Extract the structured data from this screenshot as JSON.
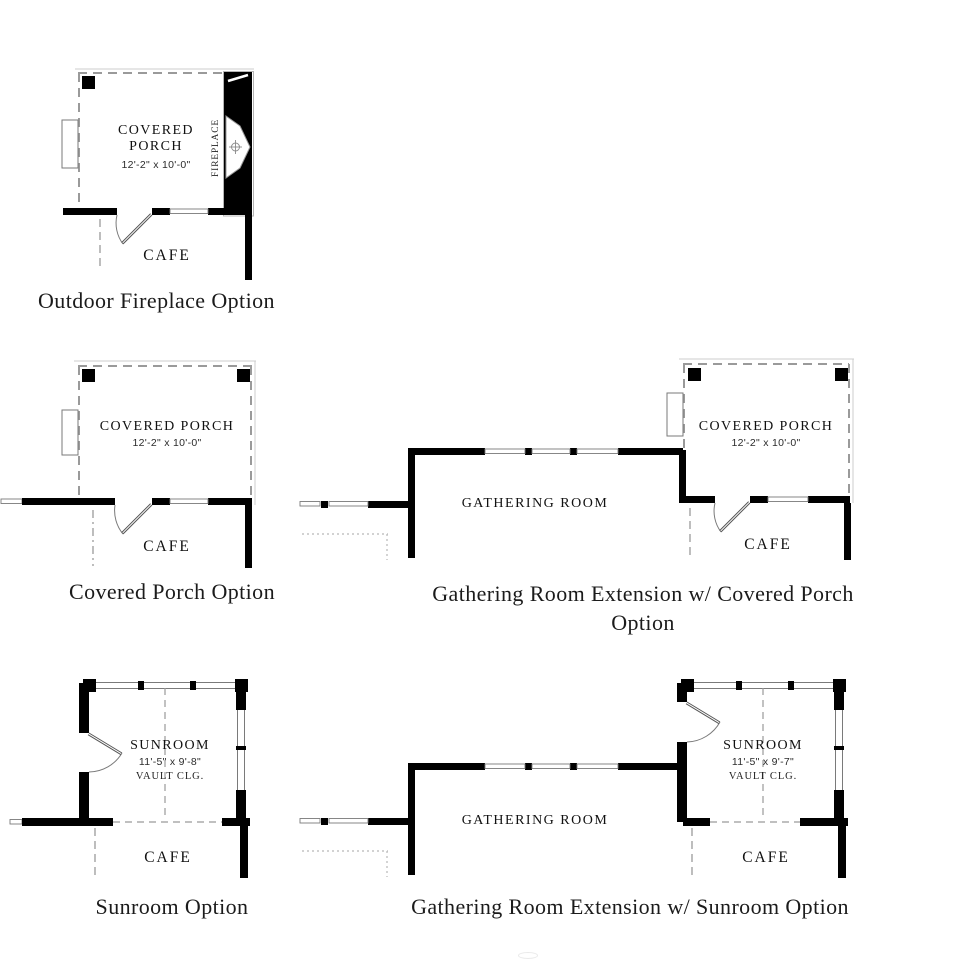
{
  "colors": {
    "wall": "#000000",
    "dashed_line": "#9a9a9a",
    "window_outline": "#7a7a7a",
    "optional_dotted": "#b8b8b8",
    "text": "#1b1b1b",
    "background": "#ffffff"
  },
  "plans": {
    "outdoor_fireplace": {
      "caption": "Outdoor Fireplace Option",
      "room": "COVERED PORCH",
      "dimensions": "12'-2\" x 10'-0\"",
      "fireplace": "FIREPLACE",
      "adjacent_room": "CAFE"
    },
    "covered_porch": {
      "caption": "Covered Porch Option",
      "room": "COVERED PORCH",
      "dimensions": "12'-2\" x 10'-0\"",
      "adjacent_room": "CAFE"
    },
    "gathering_covered_porch": {
      "caption_line1": "Gathering Room Extension w/ Covered Porch",
      "caption_line2": "Option",
      "gathering_room": "GATHERING ROOM",
      "room": "COVERED PORCH",
      "dimensions": "12'-2\" x 10'-0\"",
      "adjacent_room": "CAFE"
    },
    "sunroom": {
      "caption": "Sunroom Option",
      "room": "SUNROOM",
      "dimensions": "11'-5\" x 9'-8\"",
      "ceiling": "VAULT CLG.",
      "adjacent_room": "CAFE"
    },
    "gathering_sunroom": {
      "caption": "Gathering Room Extension w/ Sunroom Option",
      "gathering_room": "GATHERING ROOM",
      "room": "SUNROOM",
      "dimensions": "11'-5\" x 9'-7\"",
      "ceiling": "VAULT CLG.",
      "adjacent_room": "CAFE"
    }
  }
}
